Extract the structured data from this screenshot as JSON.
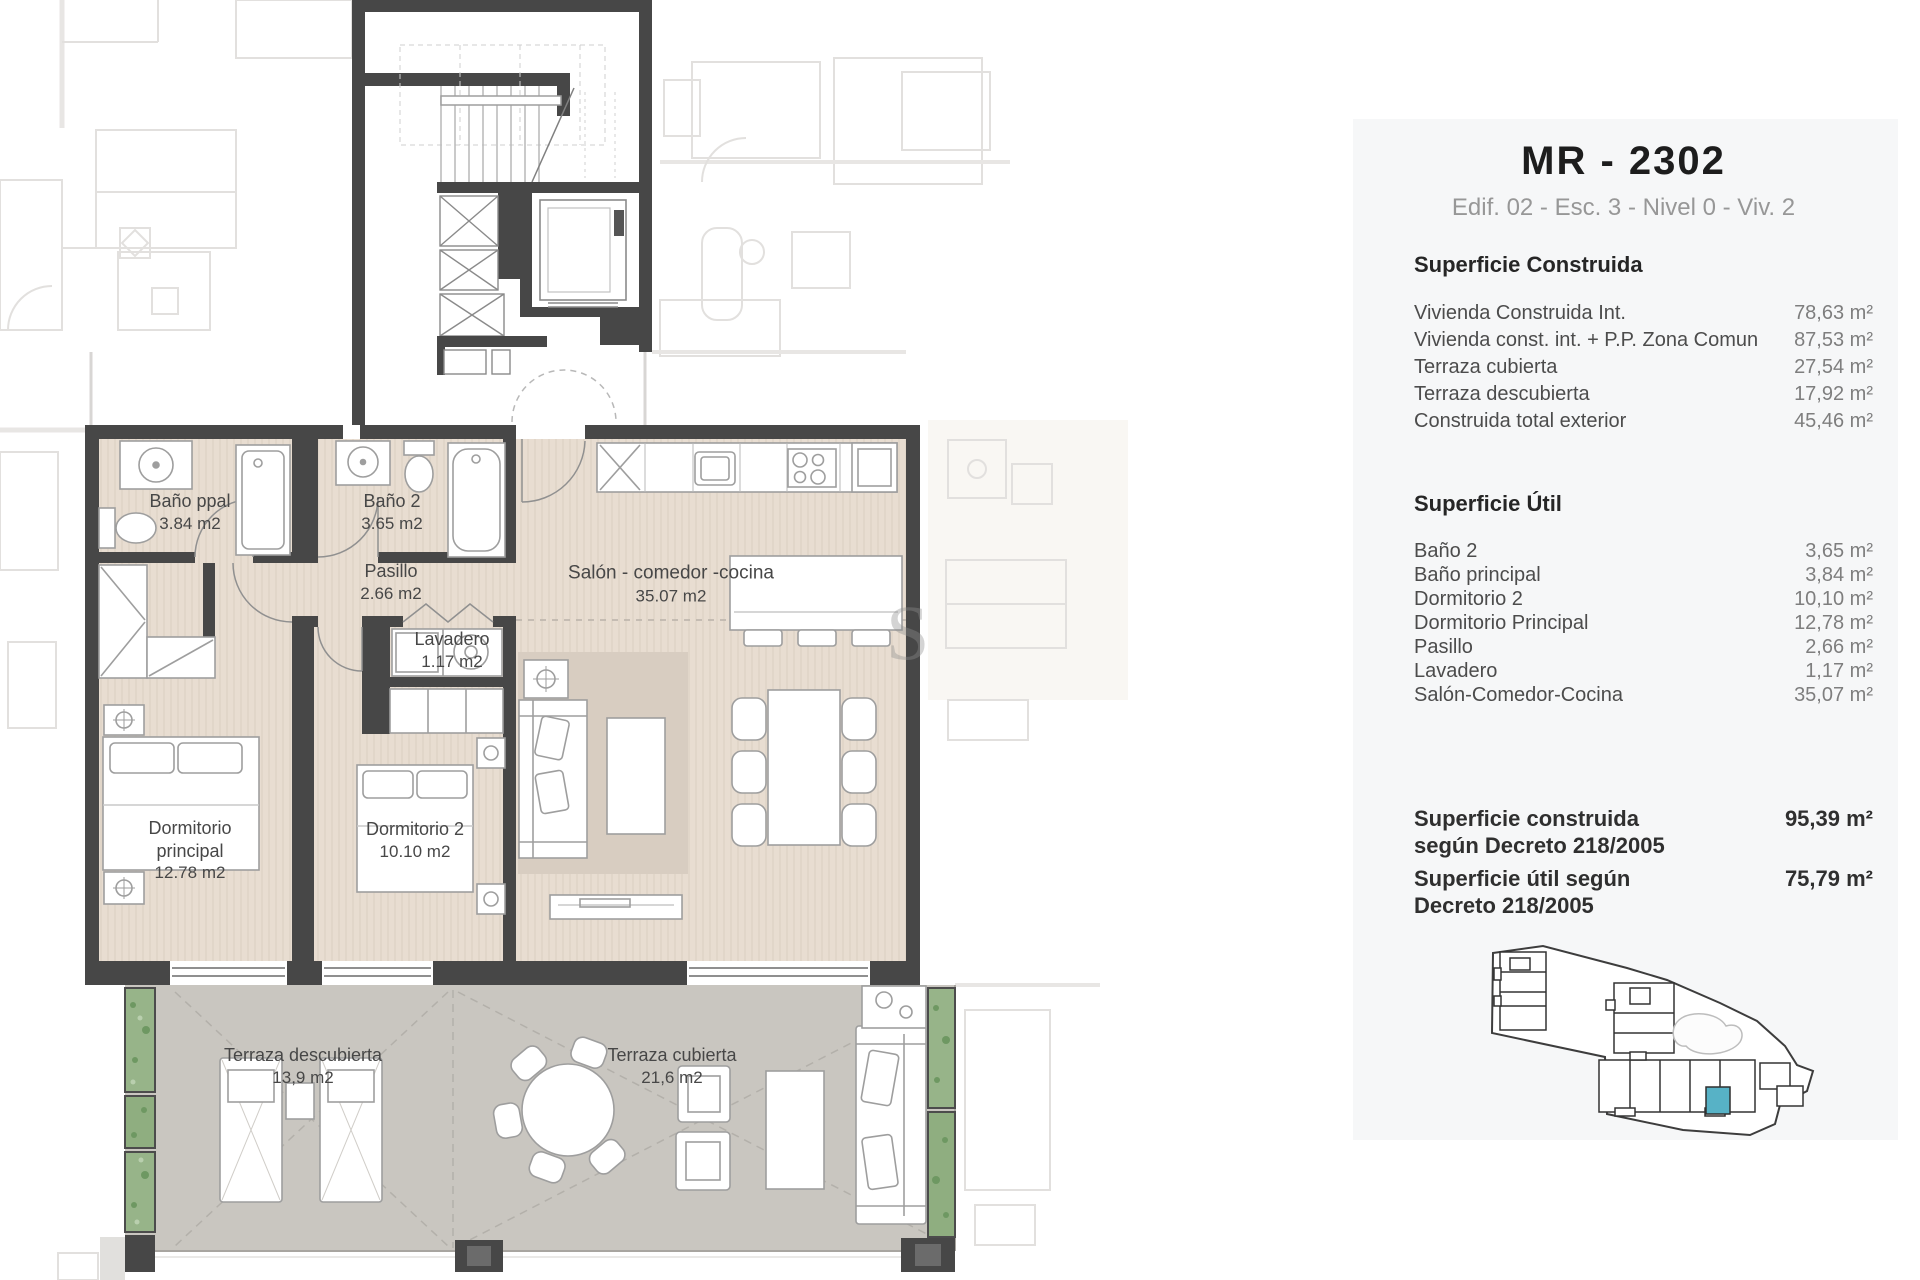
{
  "panel": {
    "title": "MR - 2302",
    "subtitle": "Edif. 02 - Esc. 3  - Nivel 0 - Viv. 2",
    "construida": {
      "heading": "Superficie Construida",
      "rows": [
        {
          "label": "Vivienda Construida Int.",
          "value": "78,63 m²"
        },
        {
          "label": "Vivienda const. int. + P.P. Zona Comun",
          "value": "87,53 m²"
        },
        {
          "label": "Terraza cubierta",
          "value": "27,54 m²"
        },
        {
          "label": "Terraza descubierta",
          "value": "17,92 m²"
        },
        {
          "label": "Construida total exterior",
          "value": "45,46 m²"
        }
      ]
    },
    "util": {
      "heading": "Superficie Útil",
      "rows": [
        {
          "label": "Baño  2",
          "value": "3,65 m²"
        },
        {
          "label": "Baño principal",
          "value": "3,84 m²"
        },
        {
          "label": "Dormitorio 2",
          "value": "10,10 m²"
        },
        {
          "label": "Dormitorio Principal",
          "value": "12,78 m²"
        },
        {
          "label": "Pasillo",
          "value": "2,66 m²"
        },
        {
          "label": "Lavadero",
          "value": "1,17 m²"
        },
        {
          "label": "Salón-Comedor-Cocina",
          "value": "35,07 m²"
        }
      ]
    },
    "totals": [
      {
        "line1": "Superficie construida",
        "line2": "según Decreto 218/2005",
        "value": "95,39 m²"
      },
      {
        "line1": "Superficie útil según",
        "line2": "Decreto 218/2005",
        "value": "75,79 m²"
      }
    ]
  },
  "plan": {
    "labels": {
      "bano_ppal": {
        "name": "Baño ppal",
        "area": "3.84 m2"
      },
      "bano_2": {
        "name": "Baño 2",
        "area": "3.65 m2"
      },
      "pasillo": {
        "name": "Pasillo",
        "area": "2.66 m2"
      },
      "lavadero": {
        "name": "Lavadero",
        "area": "1.17 m2"
      },
      "salon": {
        "name": "Salón - comedor -cocina",
        "area": "35.07 m2"
      },
      "dormitorio_principal": {
        "line1": "Dormitorio",
        "line2": "principal",
        "area": "12.78 m2"
      },
      "dormitorio_2": {
        "name": "Dormitorio 2",
        "area": "10.10 m2"
      },
      "terraza_descubierta": {
        "name": "Terraza descubierta",
        "area": "13,9 m2"
      },
      "terraza_cubierta": {
        "name": "Terraza cubierta",
        "area": "21,6 m2"
      }
    },
    "watermark": "S"
  },
  "colors": {
    "wall": "#474747",
    "floor": "#e8ddd1",
    "rug": "#d8cdc1",
    "terrace": "#c9c6c0",
    "planter": "#97b489",
    "panel_bg": "#f6f7f8",
    "highlight_teal": "#57b2c6"
  }
}
